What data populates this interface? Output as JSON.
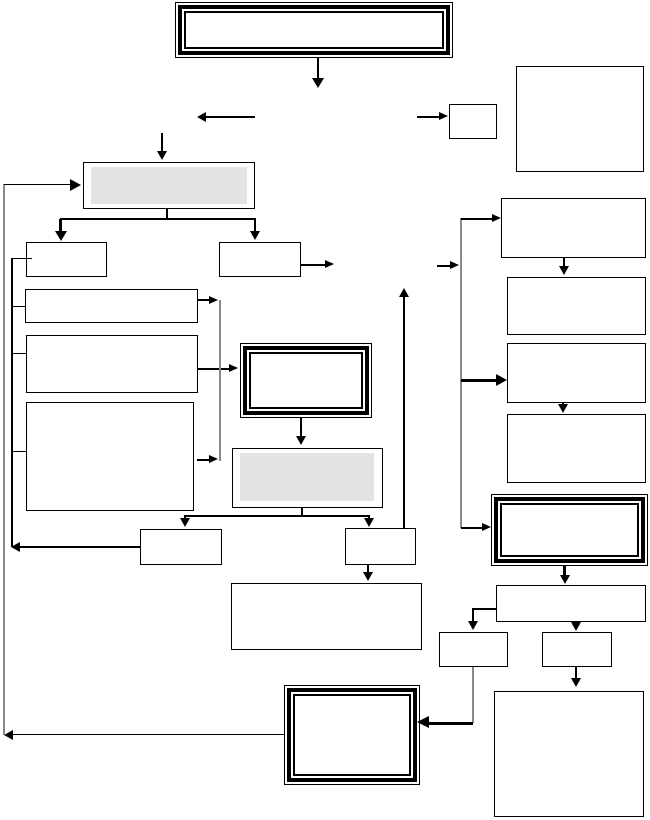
{
  "diagram": {
    "type": "flowchart",
    "text_content": "",
    "node_counts": {
      "plain_boxes": 18,
      "gray_filled_boxes": 2,
      "emphasis_double_border_boxes": 4
    },
    "emphasis_boxes": [
      "top-banner",
      "center-process",
      "right-emphasis",
      "bottom-emphasis"
    ],
    "gray_boxes": [
      "gray-step-top",
      "gray-step-middle"
    ]
  },
  "colors": {
    "line": "#000000",
    "connector": "#8a8a8a",
    "gray_fill": "#e3e3e3",
    "background": "#ffffff"
  }
}
